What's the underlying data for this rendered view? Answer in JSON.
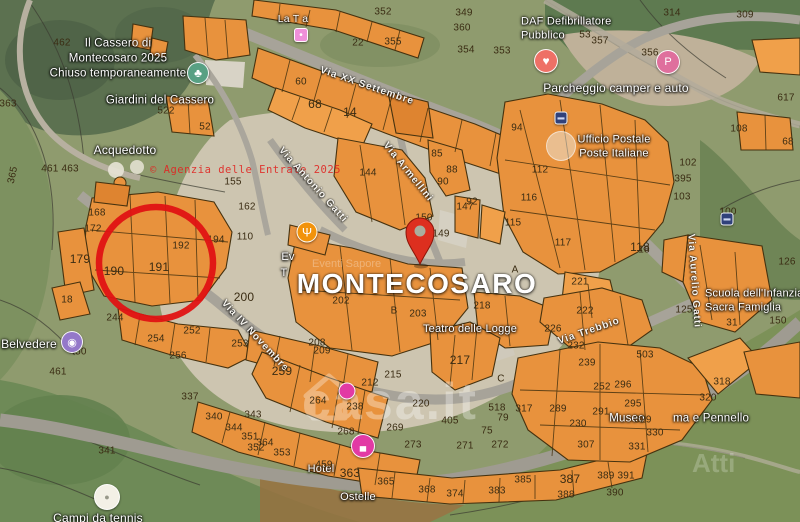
{
  "map": {
    "city_label": "MONTECOSARO",
    "watermarks": {
      "agenzia": "© Agenzia delle Entrate 2025",
      "casait": "casa.it",
      "attico": "Atti",
      "ghost": "Eventi Sapore"
    },
    "colors": {
      "parcel_fill": "#e8923d",
      "parcel_stroke": "#46320f",
      "pin_red": "#dd2f1f",
      "annotation_red": "#e01313",
      "road_gray": "#a7a399",
      "label_white": "#ffffff",
      "number_brown": "#3a2c13"
    },
    "poi_labels": [
      {
        "name": "poi-il-cassero",
        "lines": [
          "Il Cassero di",
          "Montecosaro 2025",
          "Chiuso temporaneamente"
        ],
        "x": 118,
        "y": 59,
        "s": 11.5
      },
      {
        "name": "poi-giardini-del-cassero",
        "lines": [
          "Giardini del Cassero"
        ],
        "x": 160,
        "y": 101,
        "s": 11.5
      },
      {
        "name": "poi-acquedotto",
        "lines": [
          "Acquedotto"
        ],
        "x": 125,
        "y": 151,
        "s": 12
      },
      {
        "name": "poi-belvedere",
        "lines": [
          "Belvedere"
        ],
        "x": 29,
        "y": 345,
        "s": 12
      },
      {
        "name": "poi-campi-da-tennis",
        "lines": [
          "Campi da tennis"
        ],
        "x": 98,
        "y": 519,
        "s": 12
      },
      {
        "name": "poi-daf-defibrillatore",
        "lines": [
          "DAF Defibrillatore",
          "Pubblico"
        ],
        "x": 521,
        "y": 29,
        "s": 11,
        "align": "left"
      },
      {
        "name": "poi-parcheggio-camper",
        "lines": [
          "Parcheggio camper e auto"
        ],
        "x": 616,
        "y": 89,
        "s": 12
      },
      {
        "name": "poi-ufficio-postale",
        "lines": [
          "Ufficio Postale",
          "Poste Italiane"
        ],
        "x": 614,
        "y": 147,
        "s": 11
      },
      {
        "name": "poi-teatro-delle-logge",
        "lines": [
          "Teatro delle Logge"
        ],
        "x": 470,
        "y": 329,
        "s": 11
      },
      {
        "name": "poi-museo",
        "lines": [
          "Museo"
        ],
        "x": 627,
        "y": 419,
        "s": 11.5
      },
      {
        "name": "poi-pennello",
        "lines": [
          "ma e Pennello"
        ],
        "x": 711,
        "y": 419,
        "s": 11.5
      },
      {
        "name": "poi-eventi-fragment-1",
        "lines": [
          "Ev"
        ],
        "x": 288,
        "y": 257,
        "s": 11
      },
      {
        "name": "poi-eventi-fragment-2",
        "lines": [
          "T"
        ],
        "x": 284,
        "y": 273,
        "s": 11
      },
      {
        "name": "poi-scuola-infanzia",
        "lines": [
          "Scuola dell'Infanzia",
          "Sacra Famiglia"
        ],
        "x": 705,
        "y": 301,
        "s": 11,
        "align": "left"
      },
      {
        "name": "poi-hotel",
        "lines": [
          "Hotel"
        ],
        "x": 321,
        "y": 469,
        "s": 11
      },
      {
        "name": "poi-hotel-2",
        "lines": [
          "Ostelle"
        ],
        "x": 358,
        "y": 497,
        "s": 11
      },
      {
        "name": "poi-la-tia",
        "lines": [
          "La T a"
        ],
        "x": 293,
        "y": 20,
        "s": 10.5
      }
    ],
    "street_labels": [
      {
        "name": "street-via-xx-settembre",
        "text": "Via XX Settembre",
        "x": 367,
        "y": 86,
        "r": 19
      },
      {
        "name": "street-via-antonio-gatti",
        "text": "Via Antonio Gatti",
        "x": 313,
        "y": 185,
        "r": 48
      },
      {
        "name": "street-via-armellini",
        "text": "Via Armellini",
        "x": 408,
        "y": 172,
        "r": 51
      },
      {
        "name": "street-via-iv-novembre",
        "text": "Via IV Novembre",
        "x": 255,
        "y": 336,
        "r": 47
      },
      {
        "name": "street-via-trebbio",
        "text": "Via Trebbio",
        "x": 589,
        "y": 331,
        "r": -19
      },
      {
        "name": "street-via-aurelio-gatti",
        "text": "Via Aurelio Gatti",
        "x": 694,
        "y": 281,
        "r": 86
      }
    ],
    "parcel_numbers": [
      {
        "t": "462",
        "x": 62,
        "y": 43
      },
      {
        "t": "352",
        "x": 383,
        "y": 12
      },
      {
        "t": "349",
        "x": 464,
        "y": 13
      },
      {
        "t": "360",
        "x": 462,
        "y": 28
      },
      {
        "t": "355",
        "x": 393,
        "y": 42
      },
      {
        "t": "22",
        "x": 358,
        "y": 43
      },
      {
        "t": "354",
        "x": 466,
        "y": 50
      },
      {
        "t": "353",
        "x": 502,
        "y": 51
      },
      {
        "t": "314",
        "x": 672,
        "y": 13
      },
      {
        "t": "309",
        "x": 745,
        "y": 15
      },
      {
        "t": "53",
        "x": 585,
        "y": 35
      },
      {
        "t": "357",
        "x": 600,
        "y": 41
      },
      {
        "t": "356",
        "x": 650,
        "y": 53
      },
      {
        "t": "60",
        "x": 301,
        "y": 82
      },
      {
        "t": "68",
        "x": 315,
        "y": 104,
        "s": 12
      },
      {
        "t": "14",
        "x": 350,
        "y": 112,
        "s": 12
      },
      {
        "t": "363",
        "x": 8,
        "y": 104
      },
      {
        "t": "617",
        "x": 786,
        "y": 98
      },
      {
        "t": "108",
        "x": 739,
        "y": 129
      },
      {
        "t": "68",
        "x": 788,
        "y": 142
      },
      {
        "t": "94",
        "x": 517,
        "y": 128
      },
      {
        "t": "112",
        "x": 540,
        "y": 170
      },
      {
        "t": "102",
        "x": 688,
        "y": 163
      },
      {
        "t": "395",
        "x": 683,
        "y": 179
      },
      {
        "t": "103",
        "x": 682,
        "y": 197
      },
      {
        "t": "116",
        "x": 529,
        "y": 198
      },
      {
        "t": "117",
        "x": 563,
        "y": 243
      },
      {
        "t": "118",
        "x": 640,
        "y": 247,
        "s": 12
      },
      {
        "t": "100",
        "x": 728,
        "y": 212
      },
      {
        "t": "126",
        "x": 787,
        "y": 262
      },
      {
        "t": "18",
        "x": 644,
        "y": 250
      },
      {
        "t": "125",
        "x": 684,
        "y": 310
      },
      {
        "t": "31",
        "x": 732,
        "y": 323
      },
      {
        "t": "150",
        "x": 778,
        "y": 321
      },
      {
        "t": "365",
        "x": 13,
        "y": 175,
        "r": -78
      },
      {
        "t": "461 463",
        "x": 60,
        "y": 169
      },
      {
        "t": "522",
        "x": 166,
        "y": 111
      },
      {
        "t": "52",
        "x": 205,
        "y": 127
      },
      {
        "t": "155",
        "x": 233,
        "y": 182
      },
      {
        "t": "168",
        "x": 97,
        "y": 213
      },
      {
        "t": "172",
        "x": 93,
        "y": 229
      },
      {
        "t": "179",
        "x": 80,
        "y": 259,
        "s": 12
      },
      {
        "t": "190",
        "x": 114,
        "y": 271,
        "s": 12
      },
      {
        "t": "191",
        "x": 159,
        "y": 267,
        "s": 12
      },
      {
        "t": "192",
        "x": 181,
        "y": 246
      },
      {
        "t": "194",
        "x": 216,
        "y": 240
      },
      {
        "t": "18",
        "x": 67,
        "y": 300
      },
      {
        "t": "244",
        "x": 115,
        "y": 318
      },
      {
        "t": "200",
        "x": 244,
        "y": 297,
        "s": 12
      },
      {
        "t": "450",
        "x": 78,
        "y": 352
      },
      {
        "t": "461",
        "x": 58,
        "y": 372
      },
      {
        "t": "341",
        "x": 107,
        "y": 451
      },
      {
        "t": "254",
        "x": 156,
        "y": 339
      },
      {
        "t": "252",
        "x": 192,
        "y": 331
      },
      {
        "t": "256",
        "x": 178,
        "y": 356
      },
      {
        "t": "253",
        "x": 240,
        "y": 344
      },
      {
        "t": "162",
        "x": 247,
        "y": 207
      },
      {
        "t": "110",
        "x": 245,
        "y": 237
      },
      {
        "t": "144",
        "x": 368,
        "y": 173
      },
      {
        "t": "85",
        "x": 437,
        "y": 154
      },
      {
        "t": "88",
        "x": 452,
        "y": 170
      },
      {
        "t": "90",
        "x": 443,
        "y": 182
      },
      {
        "t": "92",
        "x": 472,
        "y": 202
      },
      {
        "t": "150",
        "x": 424,
        "y": 218
      },
      {
        "t": "147",
        "x": 465,
        "y": 207
      },
      {
        "t": "115",
        "x": 513,
        "y": 223
      },
      {
        "t": "149",
        "x": 441,
        "y": 234
      },
      {
        "t": "202",
        "x": 341,
        "y": 301
      },
      {
        "t": "203",
        "x": 418,
        "y": 314
      },
      {
        "t": "B",
        "x": 394,
        "y": 311
      },
      {
        "t": "A",
        "x": 515,
        "y": 270
      },
      {
        "t": "218",
        "x": 482,
        "y": 306
      },
      {
        "t": "221",
        "x": 580,
        "y": 282
      },
      {
        "t": "222",
        "x": 585,
        "y": 311
      },
      {
        "t": "226",
        "x": 553,
        "y": 329
      },
      {
        "t": "232",
        "x": 576,
        "y": 346
      },
      {
        "t": "239",
        "x": 587,
        "y": 363
      },
      {
        "t": "217",
        "x": 460,
        "y": 360,
        "s": 12
      },
      {
        "t": "208",
        "x": 317,
        "y": 343
      },
      {
        "t": "209",
        "x": 322,
        "y": 351
      },
      {
        "t": "259",
        "x": 282,
        "y": 371,
        "s": 12
      },
      {
        "t": "264",
        "x": 318,
        "y": 401
      },
      {
        "t": "238",
        "x": 355,
        "y": 407
      },
      {
        "t": "268",
        "x": 346,
        "y": 432
      },
      {
        "t": "269",
        "x": 395,
        "y": 428
      },
      {
        "t": "215",
        "x": 393,
        "y": 375
      },
      {
        "t": "212",
        "x": 370,
        "y": 383
      },
      {
        "t": "220",
        "x": 421,
        "y": 404
      },
      {
        "t": "405",
        "x": 450,
        "y": 421
      },
      {
        "t": "518",
        "x": 497,
        "y": 408
      },
      {
        "t": "79",
        "x": 503,
        "y": 418
      },
      {
        "t": "75",
        "x": 487,
        "y": 431
      },
      {
        "t": "C",
        "x": 501,
        "y": 379
      },
      {
        "t": "343",
        "x": 253,
        "y": 415
      },
      {
        "t": "364",
        "x": 265,
        "y": 443
      },
      {
        "t": "353",
        "x": 282,
        "y": 453
      },
      {
        "t": "352",
        "x": 256,
        "y": 448
      },
      {
        "t": "459",
        "x": 324,
        "y": 465
      },
      {
        "t": "363",
        "x": 350,
        "y": 473,
        "s": 12
      },
      {
        "t": "365",
        "x": 386,
        "y": 482
      },
      {
        "t": "368",
        "x": 427,
        "y": 490
      },
      {
        "t": "374",
        "x": 455,
        "y": 494
      },
      {
        "t": "383",
        "x": 497,
        "y": 491
      },
      {
        "t": "385",
        "x": 523,
        "y": 480
      },
      {
        "t": "387",
        "x": 570,
        "y": 479,
        "s": 12
      },
      {
        "t": "389 391",
        "x": 616,
        "y": 476
      },
      {
        "t": "390",
        "x": 615,
        "y": 493
      },
      {
        "t": "388",
        "x": 566,
        "y": 495
      },
      {
        "t": "307",
        "x": 586,
        "y": 445
      },
      {
        "t": "230",
        "x": 578,
        "y": 424
      },
      {
        "t": "289",
        "x": 558,
        "y": 409
      },
      {
        "t": "291",
        "x": 601,
        "y": 412
      },
      {
        "t": "317",
        "x": 524,
        "y": 409
      },
      {
        "t": "295",
        "x": 633,
        "y": 404
      },
      {
        "t": "296",
        "x": 623,
        "y": 385
      },
      {
        "t": "503",
        "x": 645,
        "y": 355
      },
      {
        "t": "252",
        "x": 602,
        "y": 387
      },
      {
        "t": "329",
        "x": 643,
        "y": 420
      },
      {
        "t": "330",
        "x": 655,
        "y": 433
      },
      {
        "t": "331",
        "x": 637,
        "y": 447
      },
      {
        "t": "320",
        "x": 708,
        "y": 398
      },
      {
        "t": "318",
        "x": 722,
        "y": 382
      },
      {
        "t": "337",
        "x": 190,
        "y": 397
      },
      {
        "t": "340",
        "x": 214,
        "y": 417
      },
      {
        "t": "344",
        "x": 234,
        "y": 428
      },
      {
        "t": "351",
        "x": 250,
        "y": 437
      },
      {
        "t": "273",
        "x": 413,
        "y": 445
      },
      {
        "t": "271",
        "x": 465,
        "y": 446
      },
      {
        "t": "272",
        "x": 500,
        "y": 445
      }
    ],
    "markers": [
      {
        "name": "park-marker",
        "x": 198,
        "y": 73,
        "d": 22,
        "bg": "#58a083",
        "glyph": "♣",
        "gs": 12
      },
      {
        "name": "tennis-poi-marker",
        "x": 107,
        "y": 497,
        "d": 26,
        "bg": "#f3f0e6",
        "glyph": "●",
        "gc": "#98988a",
        "gs": 9
      },
      {
        "name": "belvedere-marker",
        "x": 72,
        "y": 342,
        "d": 22,
        "bg": "#9478c9",
        "glyph": "◉",
        "gs": 11
      },
      {
        "name": "defibrillator-marker",
        "x": 546,
        "y": 61,
        "d": 24,
        "bg": "#ee7066",
        "glyph": "♥",
        "gs": 12
      },
      {
        "name": "paid-parking-marker",
        "x": 668,
        "y": 62,
        "d": 24,
        "bg": "#df6f9d",
        "glyph": "P",
        "gs": 11
      },
      {
        "name": "restaurant-marker",
        "x": 307,
        "y": 232,
        "d": 21,
        "bg": "#f2930b",
        "glyph": "Ψ",
        "gs": 12
      },
      {
        "name": "hotel-marker",
        "x": 363,
        "y": 446,
        "d": 24,
        "bg": "#e23aa4",
        "glyph": "▄",
        "gs": 9
      },
      {
        "name": "hotel-marker-2",
        "x": 347,
        "y": 391,
        "d": 17,
        "bg": "#e23aa4",
        "glyph": "",
        "gs": 8
      },
      {
        "name": "shop-marker",
        "x": 301,
        "y": 35,
        "d": 14,
        "bg": "#ee8fd8",
        "glyph": "•",
        "gs": 10,
        "shape": "square"
      },
      {
        "name": "bus-stop-icon-1",
        "x": 561,
        "y": 118,
        "d": 13,
        "bg": "#30417a",
        "glyph": "▬",
        "gc": "#cdd6f2",
        "gs": 7,
        "shape": "square"
      },
      {
        "name": "bus-stop-icon-2",
        "x": 727,
        "y": 219,
        "d": 13,
        "bg": "#30417a",
        "glyph": "▬",
        "gc": "#cdd6f2",
        "gs": 7,
        "shape": "square"
      },
      {
        "name": "poste-logo-circle",
        "x": 561,
        "y": 146,
        "d": 30,
        "bg": "rgba(235,233,226,0.5)",
        "glyph": "",
        "gs": 10,
        "plain": true
      }
    ]
  }
}
